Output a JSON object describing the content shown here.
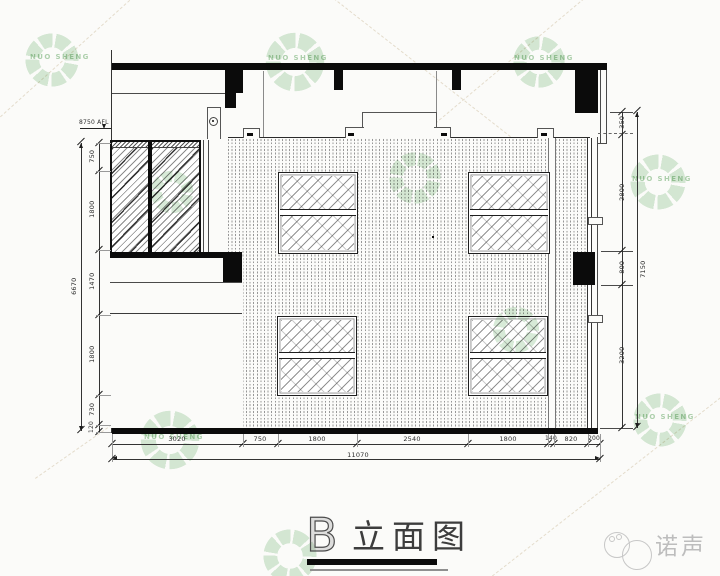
{
  "title": {
    "letter": "B",
    "name": "立面图"
  },
  "level_mark": {
    "label": "8750 AFL"
  },
  "dimensions": {
    "bottom": {
      "segments": [
        "3020",
        "750",
        "1800",
        "2540",
        "1800",
        "140",
        "820",
        "200"
      ],
      "overall": "11070"
    },
    "left": {
      "segments": [
        "750",
        "1800",
        "1470",
        "1800",
        "730",
        "120"
      ],
      "overall": "6670"
    },
    "right": {
      "segments": [
        "350",
        "2800",
        "800",
        "3200"
      ],
      "overall": "7150"
    }
  },
  "watermark": {
    "text": "NUO SHENG"
  },
  "brand": {
    "name": "诺声"
  },
  "colors": {
    "line": "#2a2a2a",
    "fill_black": "#0b0b0b",
    "watermark_green": "#7ab87a",
    "brand_gray": "#bdbdbd"
  }
}
